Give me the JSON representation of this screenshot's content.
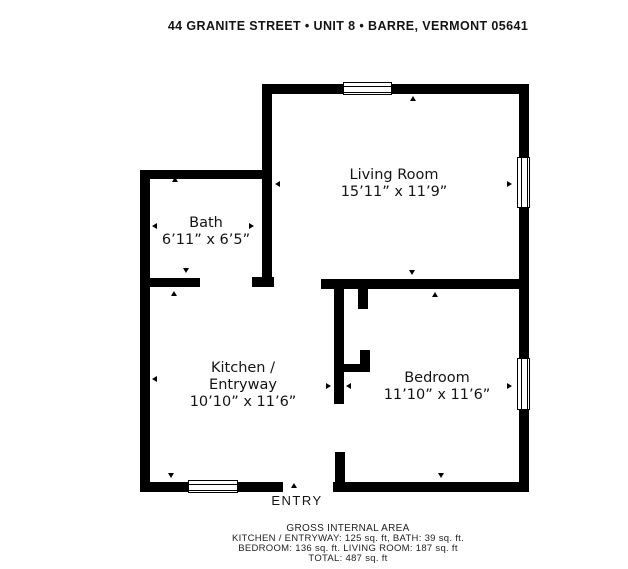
{
  "header": {
    "title": "44 GRANITE STREET • UNIT 8 • BARRE, VERMONT 05641"
  },
  "rooms": {
    "living": {
      "name": "Living Room",
      "dims": "15’11” x 11’9”"
    },
    "bath": {
      "name": "Bath",
      "dims": "6’11” x 6’5”"
    },
    "kitchen": {
      "line1": "Kitchen /",
      "line2": "Entryway",
      "dims": "10’10” x 11’6”"
    },
    "bedroom": {
      "name": "Bedroom",
      "dims": "11’10” x 11’6”"
    }
  },
  "entry": {
    "label": "ENTRY"
  },
  "footer": {
    "title": "GROSS INTERNAL AREA",
    "line1": "KITCHEN / ENTRYWAY: 125 sq. ft, BATH: 39 sq. ft.",
    "line2": "BEDROOM: 136 sq. ft. LIVING ROOM: 187 sq. ft",
    "line3": "TOTAL: 487 sq. ft"
  },
  "areas_sq_ft": {
    "kitchen_entryway": 125,
    "bath": 39,
    "bedroom": 136,
    "living_room": 187,
    "total": 487
  },
  "colors": {
    "wall": "#000000",
    "background": "#ffffff",
    "text": "#141414"
  }
}
